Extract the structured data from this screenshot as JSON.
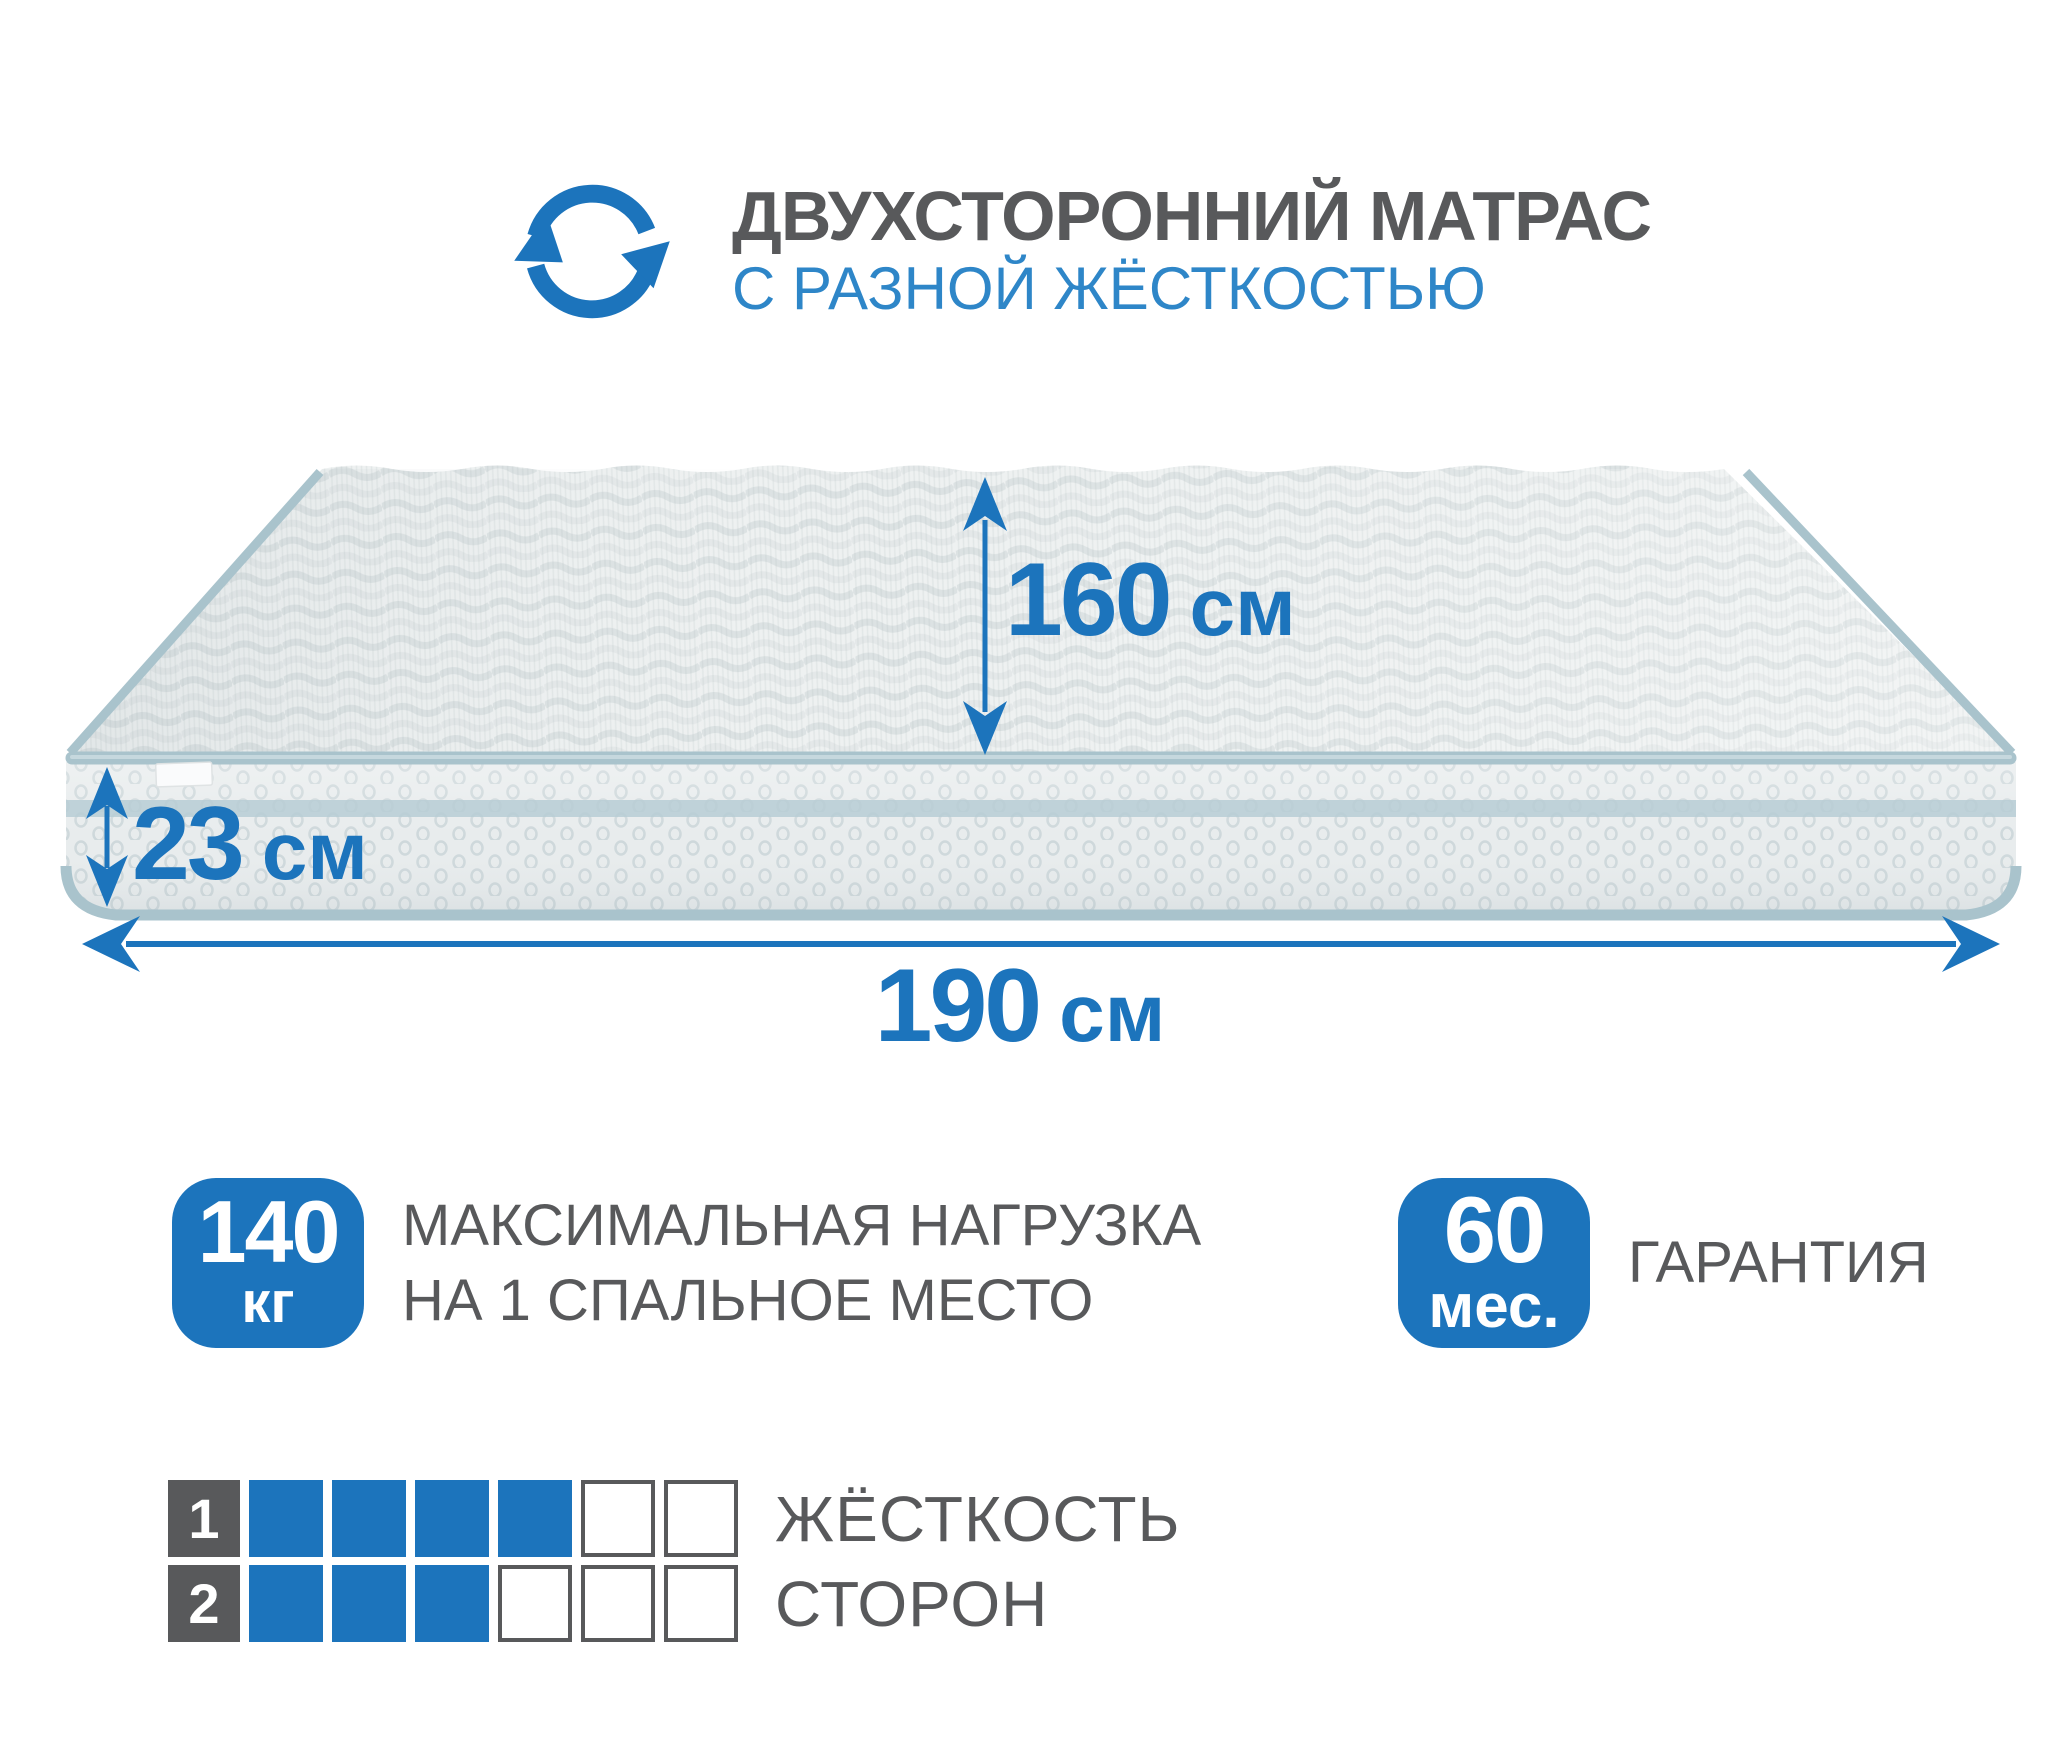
{
  "header": {
    "icon": "rotate-arrows-icon",
    "title": "ДВУХСТОРОННИЙ МАТРАС",
    "subtitle": "С РАЗНОЙ ЖЁСТКОСТЬЮ"
  },
  "colors": {
    "brand_blue": "#1c74bc",
    "subtitle_blue": "#2e86c8",
    "text_gray": "#58595b",
    "piping_teal": "#a9c3cc",
    "fabric_top": "#eef1f1",
    "fabric_side": "#e8eced",
    "side_stripe": "#b7cdd5"
  },
  "dimensions": {
    "width": {
      "value": "160",
      "unit": "см"
    },
    "height": {
      "value": "23",
      "unit": "см"
    },
    "length": {
      "value": "190",
      "unit": "см"
    }
  },
  "features": [
    {
      "badge_value": "140",
      "badge_unit": "кг",
      "label_line1": "МАКСИМАЛЬНАЯ НАГРУЗКА",
      "label_line2": "НА 1 СПАЛЬНОЕ МЕСТО"
    },
    {
      "badge_value": "60",
      "badge_unit": "мес.",
      "label_line1": "ГАРАНТИЯ",
      "label_line2": ""
    }
  ],
  "firmness": {
    "caption_line1": "ЖЁСТКОСТЬ",
    "caption_line2": "СТОРОН",
    "scale_max": 6,
    "rows": [
      {
        "side": "1",
        "filled": 4
      },
      {
        "side": "2",
        "filled": 3
      }
    ]
  }
}
